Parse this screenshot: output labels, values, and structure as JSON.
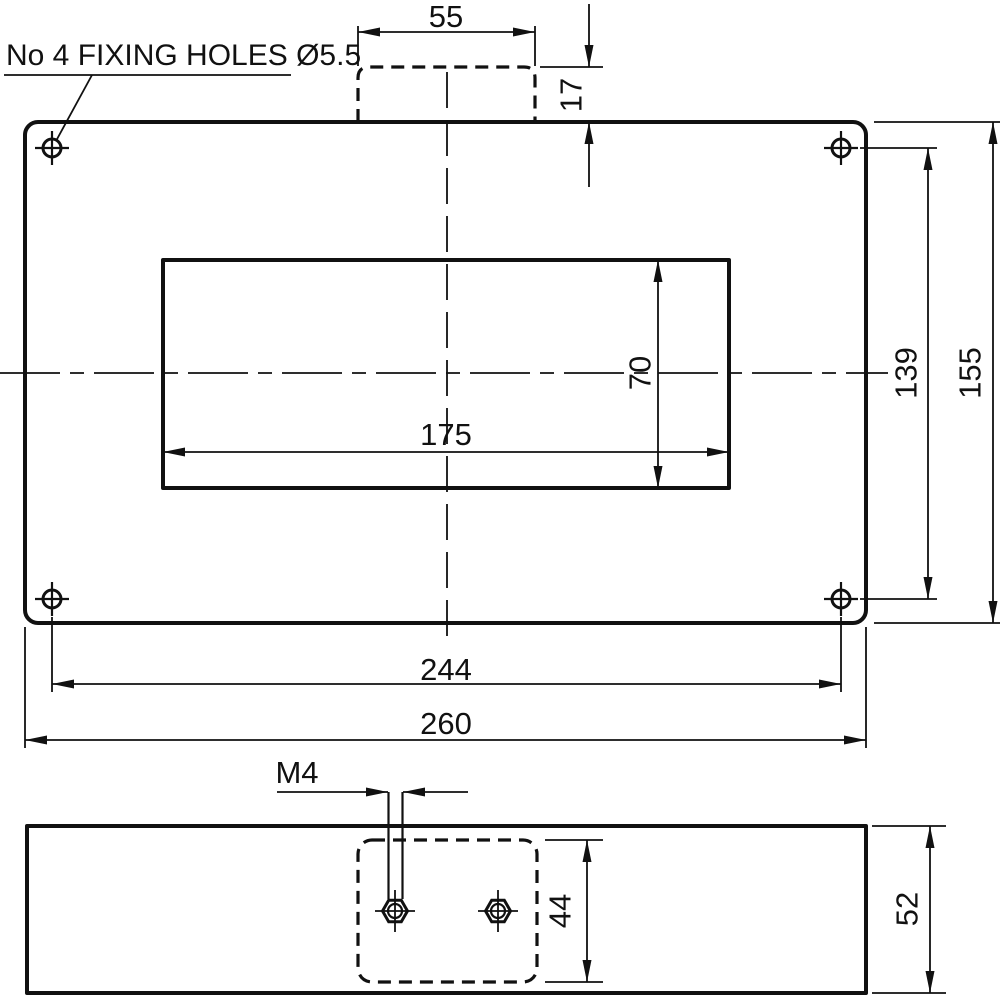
{
  "note": "No 4 FIXING HOLES Ø5.5",
  "colors": {
    "line": "#111111",
    "background": "#ffffff"
  },
  "top_view": {
    "dims": {
      "slot_width": "55",
      "slot_depth": "17",
      "cutout_height": "70",
      "cutout_width": "175",
      "hole_pitch_vertical": "139",
      "overall_height": "155",
      "hole_pitch_horizontal": "244",
      "overall_width": "260"
    }
  },
  "side_view": {
    "dims": {
      "thread": "M4",
      "boss_height": "44",
      "overall_depth": "52"
    }
  }
}
